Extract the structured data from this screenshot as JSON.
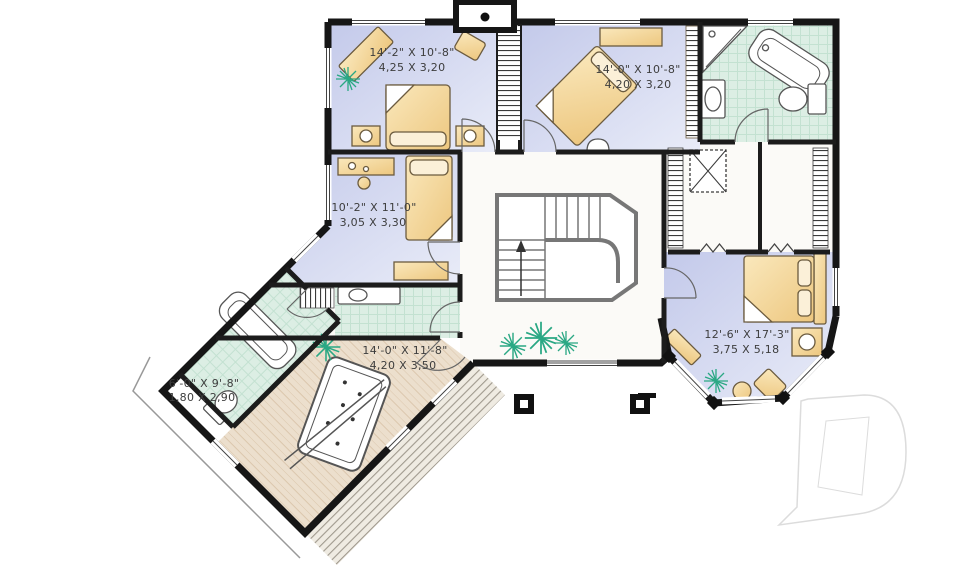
{
  "plan": {
    "type": "second-floor-plan",
    "rooms": [
      {
        "id": "bedroom-top-left",
        "imperial": "14'-2\" X 10'-8\"",
        "metric": "4,25 X 3,20"
      },
      {
        "id": "bedroom-top-center",
        "imperial": "14'-0\" X 10'-8\"",
        "metric": "4,20 X 3,20"
      },
      {
        "id": "bedroom-left",
        "imperial": "10'-2\" X 11'-0\"",
        "metric": "3,05 X 3,30"
      },
      {
        "id": "master-bedroom",
        "imperial": "12'-6\" X 17'-3\"",
        "metric": "3,75 X 5,18"
      },
      {
        "id": "bonus-room",
        "imperial": "14'-0\" X 11'-8\"",
        "metric": "4,20 X 3,50"
      },
      {
        "id": "bathroom-wing",
        "imperial": "6'-0\" X 9'-8\"",
        "metric": "1,80 X 2,90"
      }
    ],
    "watermark_letter": "D",
    "colors": {
      "wall": "#161616",
      "bedroom_floor": "#ccd2ee",
      "tile_floor": "#dceee4",
      "wood_floor": "#ecdfcd",
      "furniture": "#f4d69c",
      "plant_green": "#2aa884",
      "label_text": "#3d3d3d",
      "watermark_outline": "#dcdcdc"
    }
  }
}
